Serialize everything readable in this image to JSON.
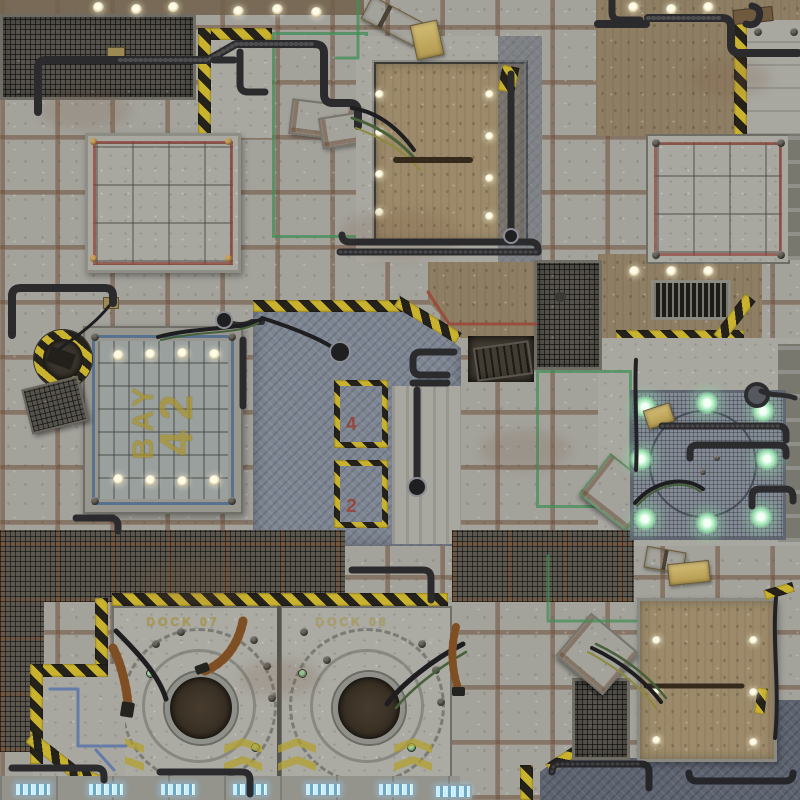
{
  "scene": {
    "description": "Top-down sci-fi industrial sector floor (tabletop game battle mat)",
    "markings": {
      "bay_label_line1": "BAY",
      "bay_label_line2": "42",
      "dock_left_label": "DOCK 07",
      "dock_right_label": "DOCK 08",
      "hazard_zone_a_marking": "4",
      "hazard_zone_b_marking": "2"
    },
    "palette": {
      "concrete": "#a8a7a0",
      "tile_grout_rust": "#6f4e36",
      "mesh_dark": "#56534c",
      "dirt_brown": "#8e7e63",
      "deck_plate_blue_gray": "#7d8592",
      "deck_plate_dark": "#5d6370",
      "hazard_yellow": "#c9b22e",
      "hazard_black": "#25221b",
      "paint_green": "#3f8f56",
      "paint_red": "#9c4434",
      "paint_blue": "#5874a8",
      "stencil_yellow": "#ab9428",
      "glow_green": "#96dfad",
      "light_cyan": "#cdeef8",
      "hose_orange": "#b5763a",
      "crate_tan": "#c9b468"
    }
  }
}
